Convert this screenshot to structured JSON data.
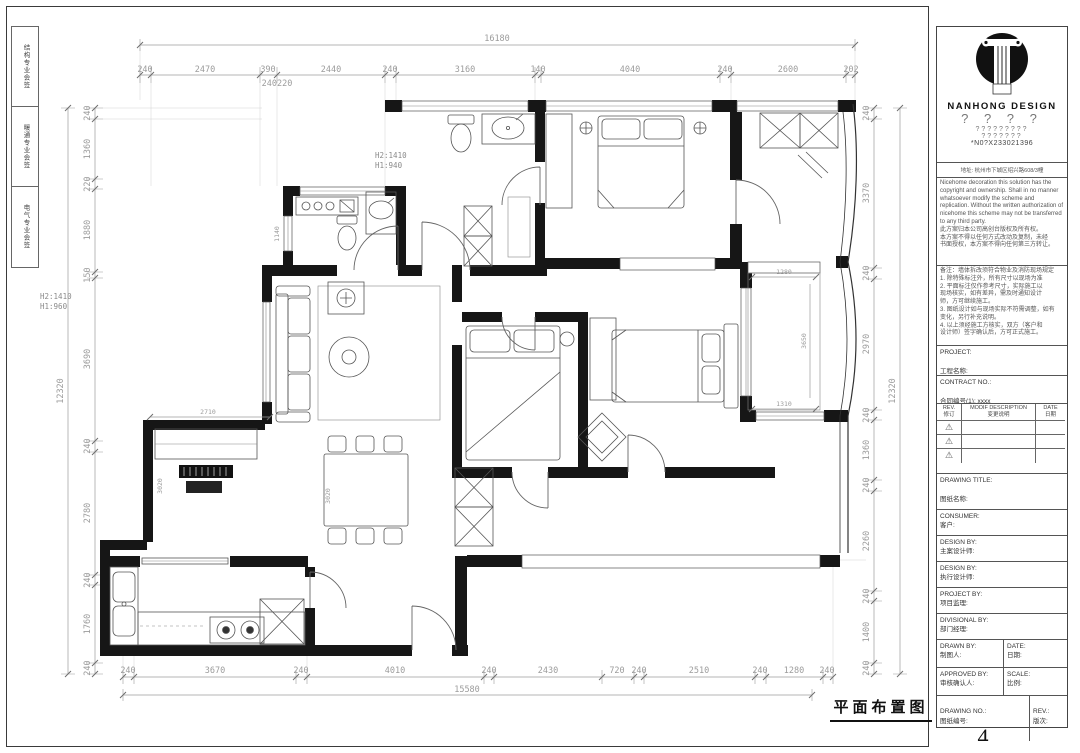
{
  "sheet": {
    "strip": [
      "结构专业会签",
      "暖通专业会签",
      "电气专业会签"
    ]
  },
  "dims": {
    "top_total": "16180",
    "top": [
      "240",
      "2470",
      "390",
      "2440",
      "240",
      "3160",
      "140",
      "4040",
      "240",
      "2600",
      "202"
    ],
    "top_sub": "240220",
    "bottom": [
      "240",
      "3670",
      "240",
      "4010",
      "240",
      "2430",
      "720",
      "240",
      "2510",
      "240",
      "1280",
      "240"
    ],
    "bottom_total": "15580",
    "left_total": "12320",
    "left": [
      "240",
      "1360",
      "220",
      "1880",
      "150",
      "3690",
      "240",
      "2780",
      "240",
      "1760",
      "240"
    ],
    "right": [
      "240",
      "3370",
      "240",
      "2970",
      "240",
      "1360",
      "240",
      "2260",
      "240",
      "1400",
      "240"
    ],
    "right_total": "12320",
    "inner": {
      "bath_top_h2": "H2:1410",
      "bath_top_h1": "H1:940",
      "bath_left_h2": "H2:1410",
      "bath_left_h1": "H1:960",
      "tv_wall": "2710",
      "bay_top": "1280",
      "bay_height": "3650",
      "bay_bottom": "1310",
      "window_left": "1140",
      "living_depth_a": "3020",
      "living_depth_b": "3020"
    }
  },
  "titleblock": {
    "brand": "NANHONG  DESIGN",
    "q_large": "? ? ? ?",
    "q_mid": "?????????",
    "q_small": "???????",
    "reg_no": "*N0?X233021396",
    "address": "地址: 杭州市下城区绍兴路608/3幢",
    "copyright_en": "Nicehome decoration this solution has the copyright and ownership. Shall in no manner whatsoever modify the scheme and replication. Without the written authorization of nicehome this scheme may not be transferred to any third party.",
    "copyright_cn1": "此方案归本公司高创台版权及所有权。",
    "copyright_cn2": "本方案不得以任何方式改动及复制，未经",
    "copyright_cn3": "书面授权，本方案不得向任何第三方转让。",
    "notes": [
      "备注：墙体拆改须符合物业及消防现场规定",
      "1. 除特殊标注外，所有尺寸以现场为准",
      "2. 平面标注仅作参考尺寸，实际施工以",
      "现场核实，如有差异，需及时通知设计",
      "师，方可继续施工。",
      "3. 图纸设计如与现场实际不符需调整，如有",
      "变化，另行补充说明。",
      "4. 以上须经施工方核实，双方（客户和",
      "设计师）签字确认后，方可正式施工。"
    ],
    "project": {
      "en": "PROJECT:",
      "cn": "工程名称:"
    },
    "contract": {
      "en": "CONTRACT NO.:",
      "cn": "合同编号(1): xxxx"
    },
    "rev_table": {
      "rev_en": "REV.",
      "rev_cn": "修订",
      "desc_en": "MODIF DESCRIPTION",
      "desc_cn": "变更说明",
      "date_en": "DATE",
      "date_cn": "日期",
      "rows": [
        "⚠",
        "⚠",
        "⚠"
      ]
    },
    "drawing_title": {
      "en": "DRAWING TITLE:",
      "cn": "图纸名称:"
    },
    "consumer": {
      "en": "CONSUMER:",
      "cn": "客户:"
    },
    "design_lead": {
      "en": "DESIGN BY:",
      "cn": "主案设计师:"
    },
    "design_exec": {
      "en": "DESIGN BY:",
      "cn": "执行设计师:"
    },
    "project_by": {
      "en": "PROJECT BY:",
      "cn": "项目监理:"
    },
    "divisional": {
      "en": "DIVISIONAL BY:",
      "cn": "部门经理:"
    },
    "drawn": {
      "en": "DRAWN BY:",
      "cn": "制图人:"
    },
    "date": {
      "en": "DATE:",
      "cn": "日期:"
    },
    "approved": {
      "en": "APPROVED BY:",
      "cn": "审核确认人:"
    },
    "scale": {
      "en": "SCALE:",
      "cn": "比例:"
    },
    "drawing_no": {
      "en": "DRAWING NO.:",
      "cn": "图纸编号:",
      "value": "4"
    },
    "rev": {
      "en": "REV.:",
      "cn": "版次:"
    }
  },
  "footer": {
    "caption": "平面布置图"
  }
}
